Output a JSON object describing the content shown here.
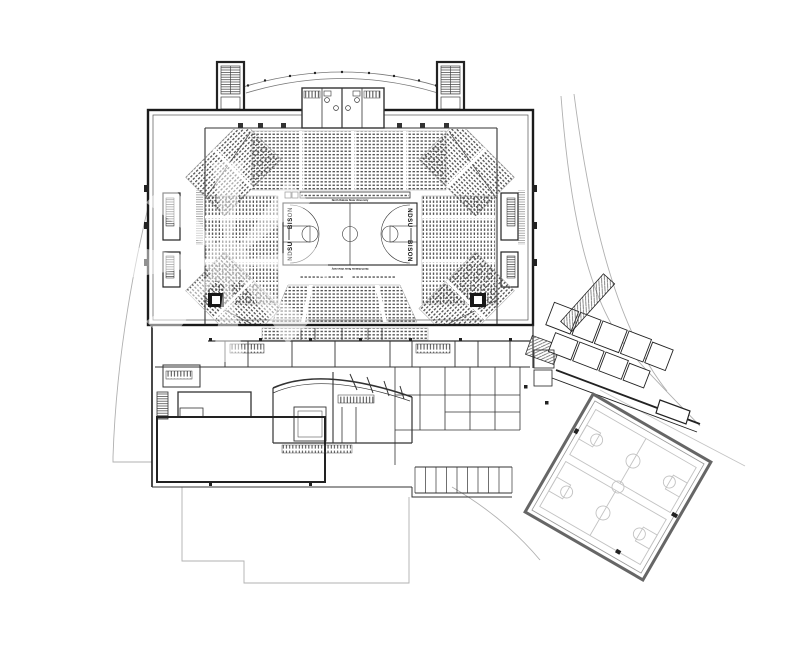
{
  "plan": {
    "court": {
      "sideline_left_upper": "BISON",
      "sideline_left_lower": "NDSU",
      "sideline_right_upper": "NDSU",
      "sideline_right_lower": "BISON",
      "baseline_top_text": "North Dakota State University",
      "baseline_bottom_text": "North Dakota State University"
    },
    "colors": {
      "paper": "#ffffff",
      "ink": "#1b1b1b",
      "medium_line": "#555555",
      "light_line": "#aaaaaa",
      "faint_court_line": "#c3c3c3",
      "seat_dot": "#4a4a4a"
    }
  }
}
